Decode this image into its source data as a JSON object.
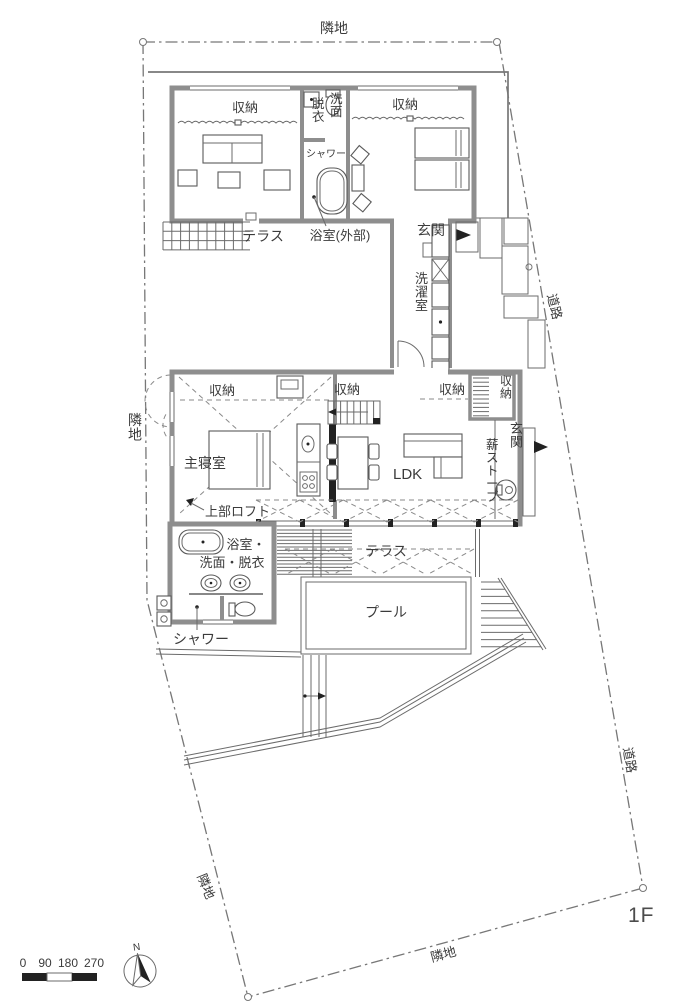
{
  "site": {
    "neighbor_top": "隣地",
    "neighbor_left": "隣地",
    "neighbor_bottom_left": "隣地",
    "neighbor_bottom": "隣地",
    "road_upper": "道路",
    "road_lower": "道路",
    "floor": "1F"
  },
  "upper_wing": {
    "storage_left": "収納",
    "storage_right": "収納",
    "dressing": "脱衣",
    "washstand": "洗面",
    "shower": "シャワー",
    "terrace": "テラス",
    "outdoor_bath": "浴室(外部)",
    "entrance": "玄関"
  },
  "corridor": {
    "laundry": "洗濯室"
  },
  "main_wing": {
    "storage_master": "収納",
    "storage_mid": "収納",
    "storage_right": "収納",
    "storage_closet": "収納",
    "master_bedroom": "主寝室",
    "loft_above": "上部ロフト",
    "ldk": "LDK",
    "entrance": "玄関",
    "wood_stove": "薪ストーブ",
    "terrace": "テラス",
    "pool": "プール",
    "bath": "浴室・",
    "wash_dressing": "洗面・脱衣",
    "shower": "シャワー"
  },
  "legend": {
    "scale_ticks": [
      "0",
      "90",
      "180",
      "270"
    ],
    "north": "N"
  },
  "colors": {
    "wall": "#8e8e8e",
    "line": "#5a5a5a",
    "text": "#3b3b3b"
  }
}
